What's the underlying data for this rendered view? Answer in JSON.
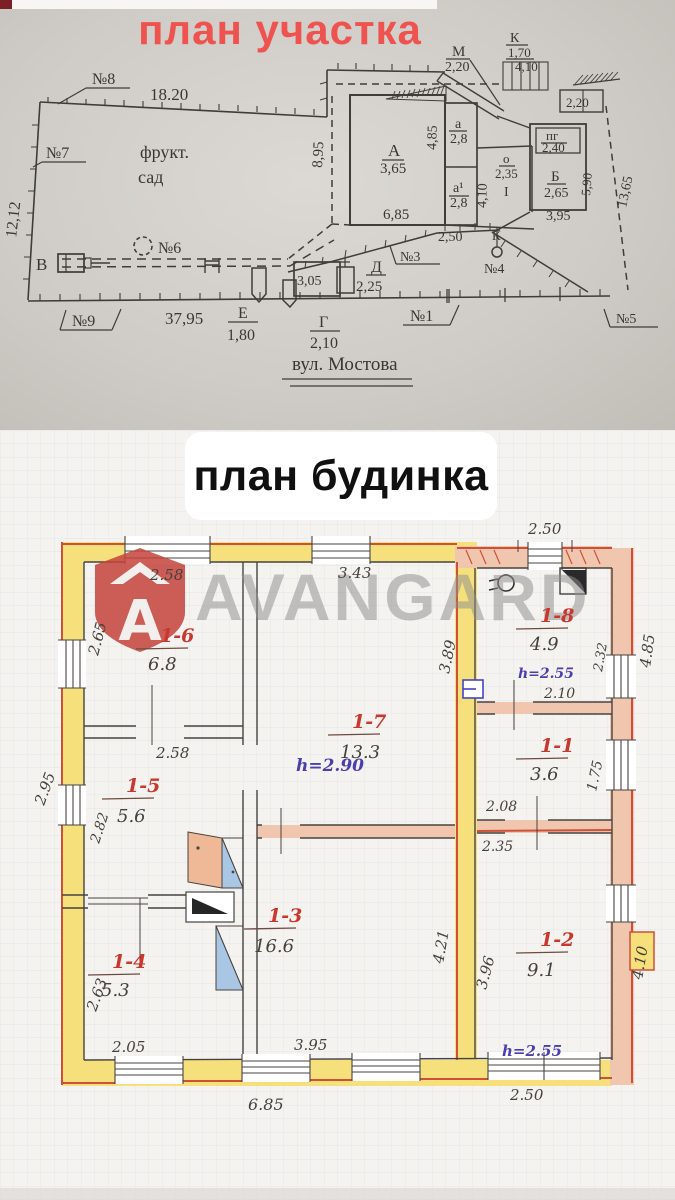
{
  "titles": {
    "site": "план участка",
    "house": "план будинка"
  },
  "watermark": {
    "text": "AVANGARD",
    "logo_color": "#c5443c"
  },
  "colors": {
    "accent_red": "#ee5350",
    "ink": "#3f3d39",
    "wall_yellow": "#f5e07c",
    "wall_pink": "#f0c6ae",
    "wall_red": "#cf5038",
    "stove_blue": "#a9c7e4",
    "stove_peach": "#efb998",
    "room_red": "#c9382e",
    "height_blue": "#4a3fae"
  },
  "site_plan": {
    "labels": [
      {
        "t": "№8",
        "x": 92,
        "y": 84,
        "s": 16
      },
      {
        "t": "18.20",
        "x": 150,
        "y": 100,
        "s": 17
      },
      {
        "t": "№7",
        "x": 46,
        "y": 158,
        "s": 16
      },
      {
        "t": "фрукт.",
        "x": 140,
        "y": 158,
        "s": 18
      },
      {
        "t": "сад",
        "x": 138,
        "y": 183,
        "s": 18
      },
      {
        "t": "12,12",
        "x": 16,
        "y": 238,
        "s": 16,
        "r": -83
      },
      {
        "t": "№6",
        "x": 158,
        "y": 253,
        "s": 16
      },
      {
        "t": "В",
        "x": 36,
        "y": 270,
        "s": 17
      },
      {
        "t": "37,95",
        "x": 165,
        "y": 324,
        "s": 17
      },
      {
        "t": "№9",
        "x": 72,
        "y": 326,
        "s": 16
      },
      {
        "t": "Е",
        "x": 238,
        "y": 318,
        "s": 16
      },
      {
        "t": "1,80",
        "x": 227,
        "y": 340,
        "s": 16
      },
      {
        "t": "Г",
        "x": 319,
        "y": 327,
        "s": 16
      },
      {
        "t": "2,10",
        "x": 310,
        "y": 348,
        "s": 16
      },
      {
        "t": "3,05",
        "x": 297,
        "y": 285,
        "s": 14
      },
      {
        "t": "Д",
        "x": 371,
        "y": 272,
        "s": 16
      },
      {
        "t": "2,25",
        "x": 356,
        "y": 291,
        "s": 15
      },
      {
        "t": "№1",
        "x": 410,
        "y": 321,
        "s": 16
      },
      {
        "t": "№3",
        "x": 400,
        "y": 261,
        "s": 14
      },
      {
        "t": "2,50",
        "x": 438,
        "y": 241,
        "s": 14
      },
      {
        "t": "К",
        "x": 492,
        "y": 240,
        "s": 13
      },
      {
        "t": "№4",
        "x": 484,
        "y": 273,
        "s": 14
      },
      {
        "t": "№5",
        "x": 616,
        "y": 323,
        "s": 14
      },
      {
        "t": "вул. Мостова",
        "x": 292,
        "y": 370,
        "s": 19
      },
      {
        "t": "8,95",
        "x": 322,
        "y": 168,
        "s": 15,
        "r": -87
      },
      {
        "t": "А",
        "x": 388,
        "y": 156,
        "s": 17
      },
      {
        "t": "3,65",
        "x": 380,
        "y": 173,
        "s": 15
      },
      {
        "t": "6,85",
        "x": 383,
        "y": 219,
        "s": 15
      },
      {
        "t": "4,85",
        "x": 436,
        "y": 150,
        "s": 14,
        "r": -88
      },
      {
        "t": "а",
        "x": 455,
        "y": 128,
        "s": 14
      },
      {
        "t": "2,8",
        "x": 450,
        "y": 143,
        "s": 14
      },
      {
        "t": "а¹",
        "x": 453,
        "y": 192,
        "s": 14
      },
      {
        "t": "2,8",
        "x": 450,
        "y": 207,
        "s": 14
      },
      {
        "t": "4,10",
        "x": 486,
        "y": 208,
        "s": 14,
        "r": -88
      },
      {
        "t": "о",
        "x": 503,
        "y": 163,
        "s": 13
      },
      {
        "t": "2,35",
        "x": 495,
        "y": 178,
        "s": 13
      },
      {
        "t": "I",
        "x": 504,
        "y": 196,
        "s": 14
      },
      {
        "t": "пг",
        "x": 546,
        "y": 140,
        "s": 13
      },
      {
        "t": "2,40",
        "x": 542,
        "y": 152,
        "s": 13
      },
      {
        "t": "Б",
        "x": 551,
        "y": 181,
        "s": 15
      },
      {
        "t": "2,65",
        "x": 544,
        "y": 197,
        "s": 14
      },
      {
        "t": "3,95",
        "x": 546,
        "y": 220,
        "s": 14
      },
      {
        "t": "5,90",
        "x": 590,
        "y": 196,
        "s": 13,
        "r": -85
      },
      {
        "t": "13,65",
        "x": 626,
        "y": 208,
        "s": 14,
        "r": -78
      },
      {
        "t": "М",
        "x": 452,
        "y": 56,
        "s": 15
      },
      {
        "t": "2,20",
        "x": 445,
        "y": 71,
        "s": 14
      },
      {
        "t": "К",
        "x": 510,
        "y": 42,
        "s": 14
      },
      {
        "t": "1,70",
        "x": 508,
        "y": 57,
        "s": 13
      },
      {
        "t": "4,10",
        "x": 515,
        "y": 71,
        "s": 13
      },
      {
        "t": "2,20",
        "x": 566,
        "y": 107,
        "s": 13
      }
    ]
  },
  "house_plan": {
    "rooms": [
      {
        "id": "1-6",
        "area": "6.8",
        "x": 160,
        "y": 212,
        "ax": 148,
        "ay": 240
      },
      {
        "id": "1-7",
        "area": "13.3",
        "x": 352,
        "y": 298,
        "ax": 340,
        "ay": 328
      },
      {
        "id": "1-8",
        "area": "4.9",
        "x": 540,
        "y": 192,
        "ax": 530,
        "ay": 220
      },
      {
        "id": "1-1",
        "area": "3.6",
        "x": 540,
        "y": 322,
        "ax": 530,
        "ay": 350
      },
      {
        "id": "1-2",
        "area": "9.1",
        "x": 540,
        "y": 516,
        "ax": 527,
        "ay": 546
      },
      {
        "id": "1-5",
        "area": "5.6",
        "x": 126,
        "y": 362,
        "ax": 117,
        "ay": 392
      },
      {
        "id": "1-4",
        "area": "5.3",
        "x": 112,
        "y": 538,
        "ax": 101,
        "ay": 566
      },
      {
        "id": "1-3",
        "area": "16.6",
        "x": 268,
        "y": 492,
        "ax": 254,
        "ay": 522
      }
    ],
    "heights": [
      {
        "t": "h=2.90",
        "x": 296,
        "y": 341,
        "s": 17
      },
      {
        "t": "h=2.55",
        "x": 518,
        "y": 248,
        "s": 14
      },
      {
        "t": "h=2.55",
        "x": 502,
        "y": 626,
        "s": 15
      }
    ],
    "dims": [
      {
        "t": "2.50",
        "x": 528,
        "y": 104,
        "s": 15
      },
      {
        "t": "2.58",
        "x": 150,
        "y": 150,
        "s": 15
      },
      {
        "t": "3.43",
        "x": 338,
        "y": 148,
        "s": 15
      },
      {
        "t": "2.65",
        "x": 98,
        "y": 226,
        "s": 15,
        "r": -75
      },
      {
        "t": "2.95",
        "x": 44,
        "y": 376,
        "s": 15,
        "r": -70
      },
      {
        "t": "2.82",
        "x": 99,
        "y": 414,
        "s": 14,
        "r": -72
      },
      {
        "t": "2.58",
        "x": 156,
        "y": 328,
        "s": 15
      },
      {
        "t": "2.63",
        "x": 96,
        "y": 582,
        "s": 15,
        "r": -70
      },
      {
        "t": "2.05",
        "x": 112,
        "y": 622,
        "s": 15
      },
      {
        "t": "3.95",
        "x": 294,
        "y": 620,
        "s": 15
      },
      {
        "t": "6.85",
        "x": 248,
        "y": 680,
        "s": 16
      },
      {
        "t": "2.50",
        "x": 510,
        "y": 670,
        "s": 15
      },
      {
        "t": "3.89",
        "x": 449,
        "y": 244,
        "s": 15,
        "r": -78
      },
      {
        "t": "4.21",
        "x": 443,
        "y": 534,
        "s": 15,
        "r": -80
      },
      {
        "t": "3.96",
        "x": 486,
        "y": 560,
        "s": 15,
        "r": -75
      },
      {
        "t": "2.35",
        "x": 482,
        "y": 421,
        "s": 14
      },
      {
        "t": "2.08",
        "x": 486,
        "y": 381,
        "s": 14
      },
      {
        "t": "2.10",
        "x": 544,
        "y": 268,
        "s": 14
      },
      {
        "t": "1.75",
        "x": 596,
        "y": 362,
        "s": 14,
        "r": -78
      },
      {
        "t": "2.32",
        "x": 602,
        "y": 242,
        "s": 13,
        "r": -80
      },
      {
        "t": "4.85",
        "x": 650,
        "y": 238,
        "s": 15,
        "r": -82
      },
      {
        "t": "4.10",
        "x": 642,
        "y": 550,
        "s": 15,
        "r": -80
      }
    ]
  }
}
